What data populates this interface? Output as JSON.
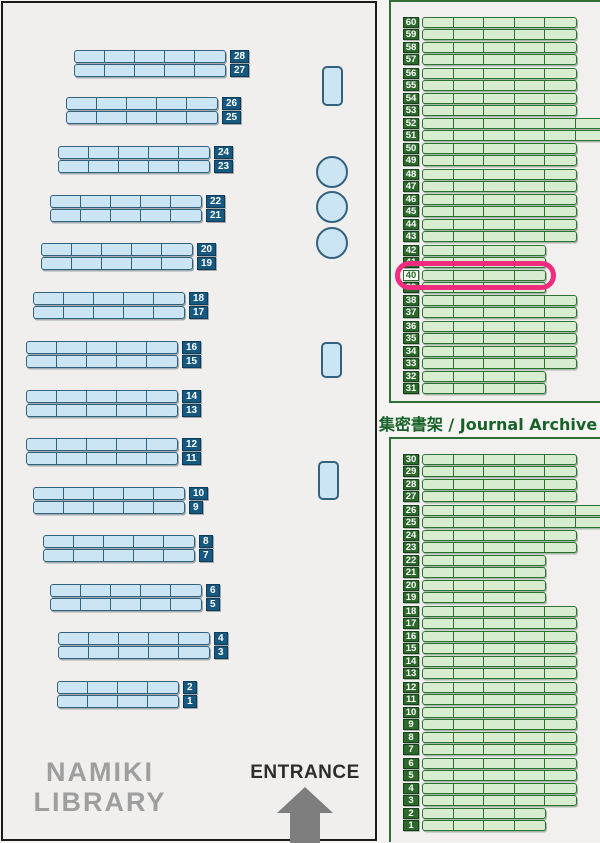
{
  "map_title": {
    "line1": "NAMIKI",
    "line2": "LIBRARY"
  },
  "entrance": {
    "label": "ENTRANCE"
  },
  "archive_label": "集密書架 / Journal Archive",
  "colors": {
    "leftBg": "#f0efed",
    "mapBorder": "#1b1b1b",
    "blueFill": "#cbe5f4",
    "blueBorder": "#33627f",
    "blueTag": "#165980",
    "panelBg": "#f1f0ee",
    "panelBorder": "#2e7033",
    "greenFill": "#d8ecd0",
    "greenBorder": "#2e7233",
    "greenTag": "#2b6a2b",
    "labelGreen": "#186229",
    "highlight": "#f12b7d",
    "titleGray": "#9e9e9e",
    "entranceText": "#2d2d2d",
    "arrowGray": "#7e7e7e"
  },
  "left_shelves": {
    "pairs": [
      {
        "top": 28,
        "bottom": 27,
        "x": 74,
        "y": 50,
        "cells": 5
      },
      {
        "top": 26,
        "bottom": 25,
        "x": 66,
        "y": 97,
        "cells": 5
      },
      {
        "top": 24,
        "bottom": 23,
        "x": 58,
        "y": 146,
        "cells": 5
      },
      {
        "top": 22,
        "bottom": 21,
        "x": 50,
        "y": 195,
        "cells": 5
      },
      {
        "top": 20,
        "bottom": 19,
        "x": 41,
        "y": 243,
        "cells": 5
      },
      {
        "top": 18,
        "bottom": 17,
        "x": 33,
        "y": 292,
        "cells": 5
      },
      {
        "top": 16,
        "bottom": 15,
        "x": 26,
        "y": 341,
        "cells": 5
      },
      {
        "top": 14,
        "bottom": 13,
        "x": 26,
        "y": 390,
        "cells": 5
      },
      {
        "top": 12,
        "bottom": 11,
        "x": 26,
        "y": 438,
        "cells": 5
      },
      {
        "top": 10,
        "bottom": 9,
        "x": 33,
        "y": 487,
        "cells": 5
      },
      {
        "top": 8,
        "bottom": 7,
        "x": 43,
        "y": 535,
        "cells": 5
      },
      {
        "top": 6,
        "bottom": 5,
        "x": 50,
        "y": 584,
        "cells": 5
      },
      {
        "top": 4,
        "bottom": 3,
        "x": 58,
        "y": 632,
        "cells": 5
      },
      {
        "top": 2,
        "bottom": 1,
        "x": 57,
        "y": 681,
        "cells": 4
      }
    ]
  },
  "fixtures": {
    "pillars": [
      {
        "x": 322,
        "y": 66,
        "w": 21,
        "h": 40
      },
      {
        "x": 321,
        "y": 342,
        "w": 21,
        "h": 36
      },
      {
        "x": 318,
        "y": 461,
        "w": 21,
        "h": 39
      }
    ],
    "tables": [
      {
        "cx": 332,
        "cy": 172,
        "r": 16
      },
      {
        "cx": 332,
        "cy": 207,
        "r": 16
      },
      {
        "cx": 332,
        "cy": 243,
        "r": 16
      }
    ]
  },
  "journal_archive": {
    "highlighted_row": 40,
    "top_panel_rows": [
      {
        "num": 60,
        "size": "full"
      },
      {
        "num": 59,
        "size": "full"
      },
      {
        "num": 58,
        "size": "full"
      },
      {
        "num": 57,
        "size": "full"
      },
      {
        "num": 56,
        "size": "full"
      },
      {
        "num": 55,
        "size": "full"
      },
      {
        "num": 54,
        "size": "full"
      },
      {
        "num": 53,
        "size": "full"
      },
      {
        "num": 52,
        "size": "long"
      },
      {
        "num": 51,
        "size": "long"
      },
      {
        "num": 50,
        "size": "full"
      },
      {
        "num": 49,
        "size": "full"
      },
      {
        "num": 48,
        "size": "full"
      },
      {
        "num": 47,
        "size": "full"
      },
      {
        "num": 46,
        "size": "full"
      },
      {
        "num": 45,
        "size": "full"
      },
      {
        "num": 44,
        "size": "full"
      },
      {
        "num": 43,
        "size": "full"
      },
      {
        "num": 42,
        "size": "short"
      },
      {
        "num": 41,
        "size": "short"
      },
      {
        "num": 40,
        "size": "short"
      },
      {
        "num": 39,
        "size": "short"
      },
      {
        "num": 38,
        "size": "full"
      },
      {
        "num": 37,
        "size": "full"
      },
      {
        "num": 36,
        "size": "full"
      },
      {
        "num": 35,
        "size": "full"
      },
      {
        "num": 34,
        "size": "full"
      },
      {
        "num": 33,
        "size": "full"
      },
      {
        "num": 32,
        "size": "short"
      },
      {
        "num": 31,
        "size": "short"
      }
    ],
    "bottom_panel_rows": [
      {
        "num": 30,
        "size": "full"
      },
      {
        "num": 29,
        "size": "full"
      },
      {
        "num": 28,
        "size": "full"
      },
      {
        "num": 27,
        "size": "full"
      },
      {
        "num": 26,
        "size": "long"
      },
      {
        "num": 25,
        "size": "long"
      },
      {
        "num": 24,
        "size": "full"
      },
      {
        "num": 23,
        "size": "full"
      },
      {
        "num": 22,
        "size": "short"
      },
      {
        "num": 21,
        "size": "short"
      },
      {
        "num": 20,
        "size": "short"
      },
      {
        "num": 19,
        "size": "short"
      },
      {
        "num": 18,
        "size": "full"
      },
      {
        "num": 17,
        "size": "full"
      },
      {
        "num": 16,
        "size": "full"
      },
      {
        "num": 15,
        "size": "full"
      },
      {
        "num": 14,
        "size": "full"
      },
      {
        "num": 13,
        "size": "full"
      },
      {
        "num": 12,
        "size": "full"
      },
      {
        "num": 11,
        "size": "full"
      },
      {
        "num": 10,
        "size": "full"
      },
      {
        "num": 9,
        "size": "full"
      },
      {
        "num": 8,
        "size": "full"
      },
      {
        "num": 7,
        "size": "full"
      },
      {
        "num": 6,
        "size": "full"
      },
      {
        "num": 5,
        "size": "full"
      },
      {
        "num": 4,
        "size": "full"
      },
      {
        "num": 3,
        "size": "full"
      },
      {
        "num": 2,
        "size": "short"
      },
      {
        "num": 1,
        "size": "short"
      }
    ]
  }
}
